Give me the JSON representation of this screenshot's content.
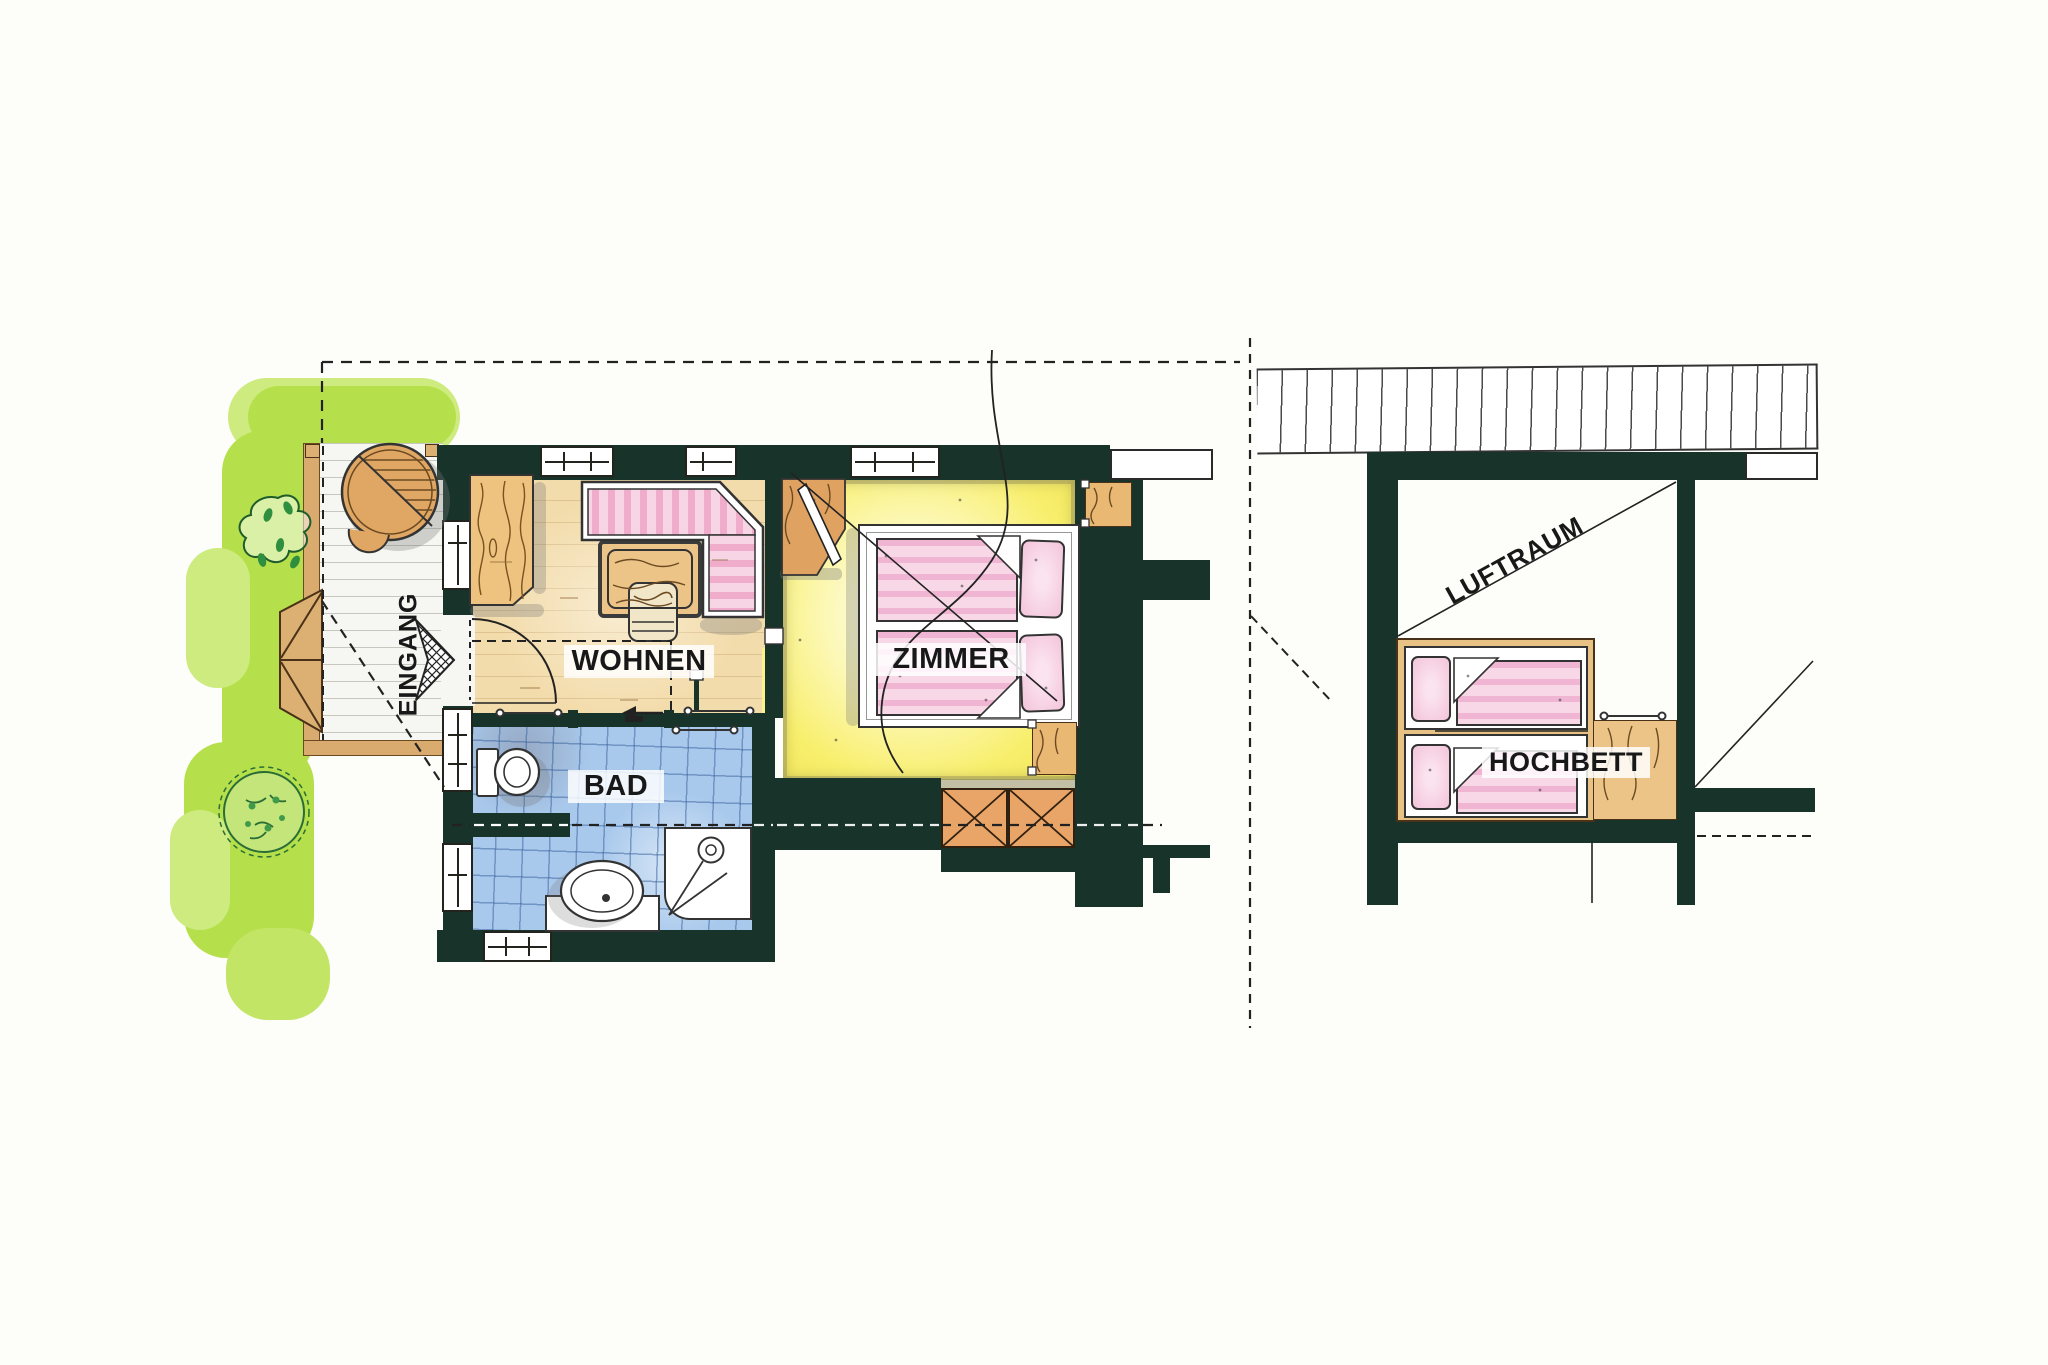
{
  "drawing": {
    "type": "hand-drawn apartment floor plan, two views (ground floor and loft)",
    "labels": {
      "eingang": "EINGANG",
      "wohnen": "WOHNEN",
      "bad": "BAD",
      "zimmer": "ZIMMER",
      "luftraum": "LUFTRAUM",
      "hochbett": "HOCHBETT"
    },
    "colors": {
      "wall": "#17332a",
      "paper": "#fdfdfa",
      "lawn_green": "#b5e04c",
      "lawn_light": "#cdeb7e",
      "deck_white": "#f6f6f2",
      "wood_floor": "#f3dcab",
      "furniture_wood": "#e9b873",
      "tile_blue": "#a9c9ec",
      "floor_yellow": "#f8ef6e",
      "bedding_pink": "#f3c3da",
      "crate_orange": "#e9a467"
    }
  }
}
